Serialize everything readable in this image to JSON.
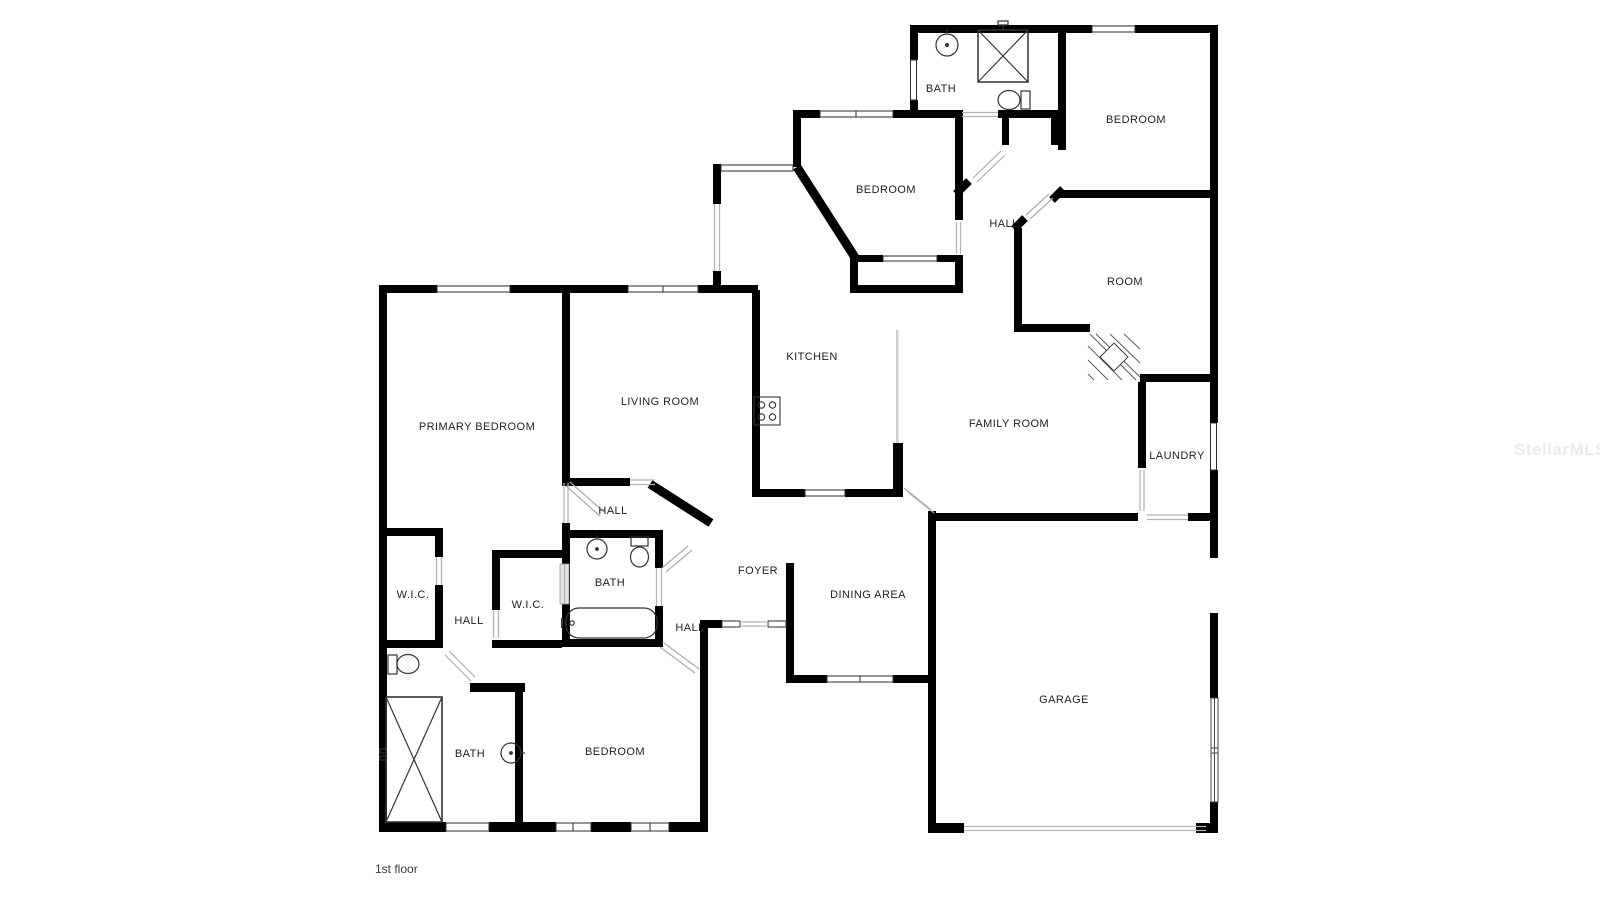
{
  "floor_plan": {
    "floor_label": "1st floor",
    "watermark": "StellarMLS",
    "wall_color": "#000000",
    "rooms": [
      {
        "id": "bath-upper",
        "label": "BATH",
        "x": 941,
        "y": 89
      },
      {
        "id": "bedroom-upper-right",
        "label": "BEDROOM",
        "x": 1136,
        "y": 120
      },
      {
        "id": "bedroom-middle",
        "label": "BEDROOM",
        "x": 886,
        "y": 190
      },
      {
        "id": "hall-upper",
        "label": "HALL",
        "x": 1004,
        "y": 224
      },
      {
        "id": "room",
        "label": "ROOM",
        "x": 1125,
        "y": 282
      },
      {
        "id": "laundry",
        "label": "LAUNDRY",
        "x": 1177,
        "y": 456
      },
      {
        "id": "kitchen",
        "label": "KITCHEN",
        "x": 812,
        "y": 357
      },
      {
        "id": "living-room",
        "label": "LIVING ROOM",
        "x": 660,
        "y": 402
      },
      {
        "id": "primary-bedroom",
        "label": "PRIMARY BEDROOM",
        "x": 477,
        "y": 427
      },
      {
        "id": "family-room",
        "label": "FAMILY ROOM",
        "x": 1009,
        "y": 424
      },
      {
        "id": "hall-center",
        "label": "HALL",
        "x": 613,
        "y": 511
      },
      {
        "id": "bath-center",
        "label": "BATH",
        "x": 610,
        "y": 583
      },
      {
        "id": "wic-left",
        "label": "W.I.C.",
        "x": 413,
        "y": 595
      },
      {
        "id": "hall-left",
        "label": "HALL",
        "x": 469,
        "y": 621
      },
      {
        "id": "wic-center",
        "label": "W.I.C.",
        "x": 528,
        "y": 605
      },
      {
        "id": "foyer",
        "label": "FOYER",
        "x": 758,
        "y": 571
      },
      {
        "id": "dining-area",
        "label": "DINING AREA",
        "x": 868,
        "y": 595
      },
      {
        "id": "hall-lower",
        "label": "HALL",
        "x": 690,
        "y": 628
      },
      {
        "id": "bedroom-lower",
        "label": "BEDROOM",
        "x": 615,
        "y": 752
      },
      {
        "id": "bath-lower",
        "label": "BATH",
        "x": 470,
        "y": 754
      },
      {
        "id": "garage",
        "label": "GARAGE",
        "x": 1064,
        "y": 700
      }
    ]
  }
}
